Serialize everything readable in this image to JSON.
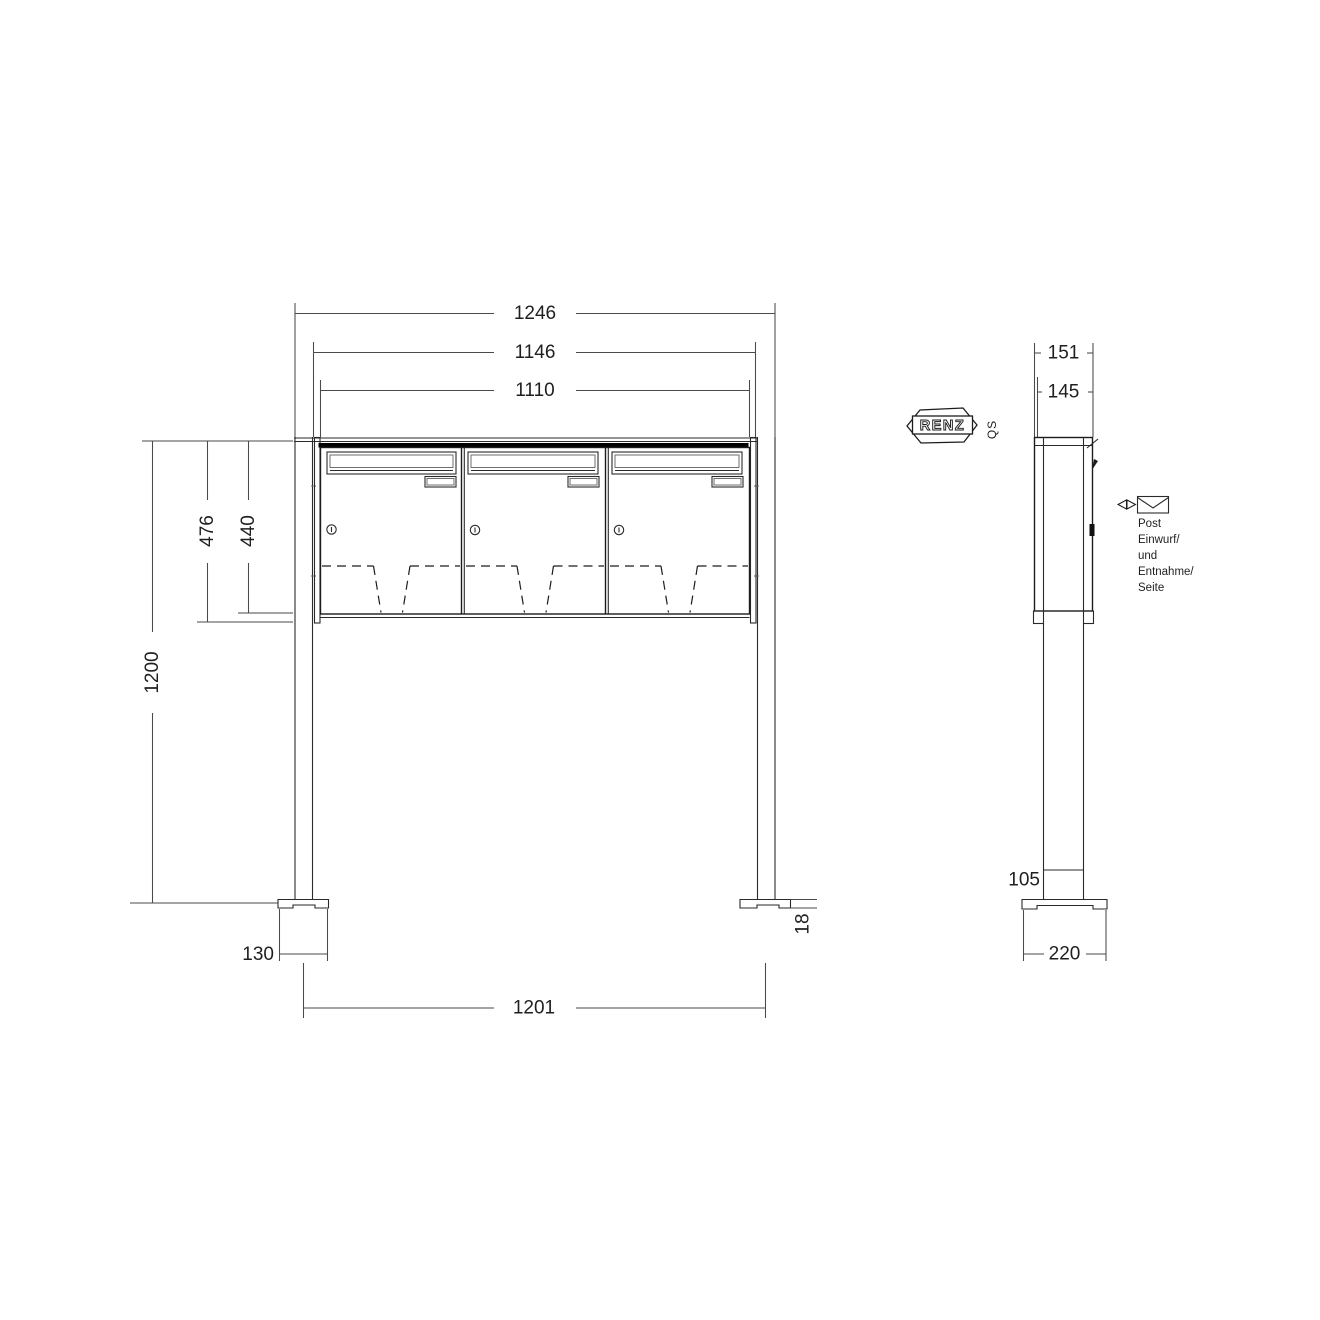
{
  "front_view": {
    "dims": {
      "total_width": "1246",
      "cabinet_width": "1146",
      "body_width": "1110",
      "height_with_trim": "476",
      "body_height": "440",
      "post_height": "1200",
      "foundation_width": "130",
      "post_spacing": "1201",
      "plate_thickness": "18"
    },
    "compartment_count": 3
  },
  "side_view": {
    "dims": {
      "total_depth": "151",
      "body_depth": "145",
      "post_base_height": "105",
      "foundation_depth": "220"
    },
    "annotation": {
      "lines": [
        "Post",
        "Einwurf/",
        "und",
        "Entnahme/",
        "Seite"
      ]
    }
  },
  "brand": {
    "logo": "RENZ",
    "qs": "QS"
  },
  "colors": {
    "background": "#ffffff",
    "line": "#1c1c1c",
    "dim_line": "#4a4a4a"
  }
}
